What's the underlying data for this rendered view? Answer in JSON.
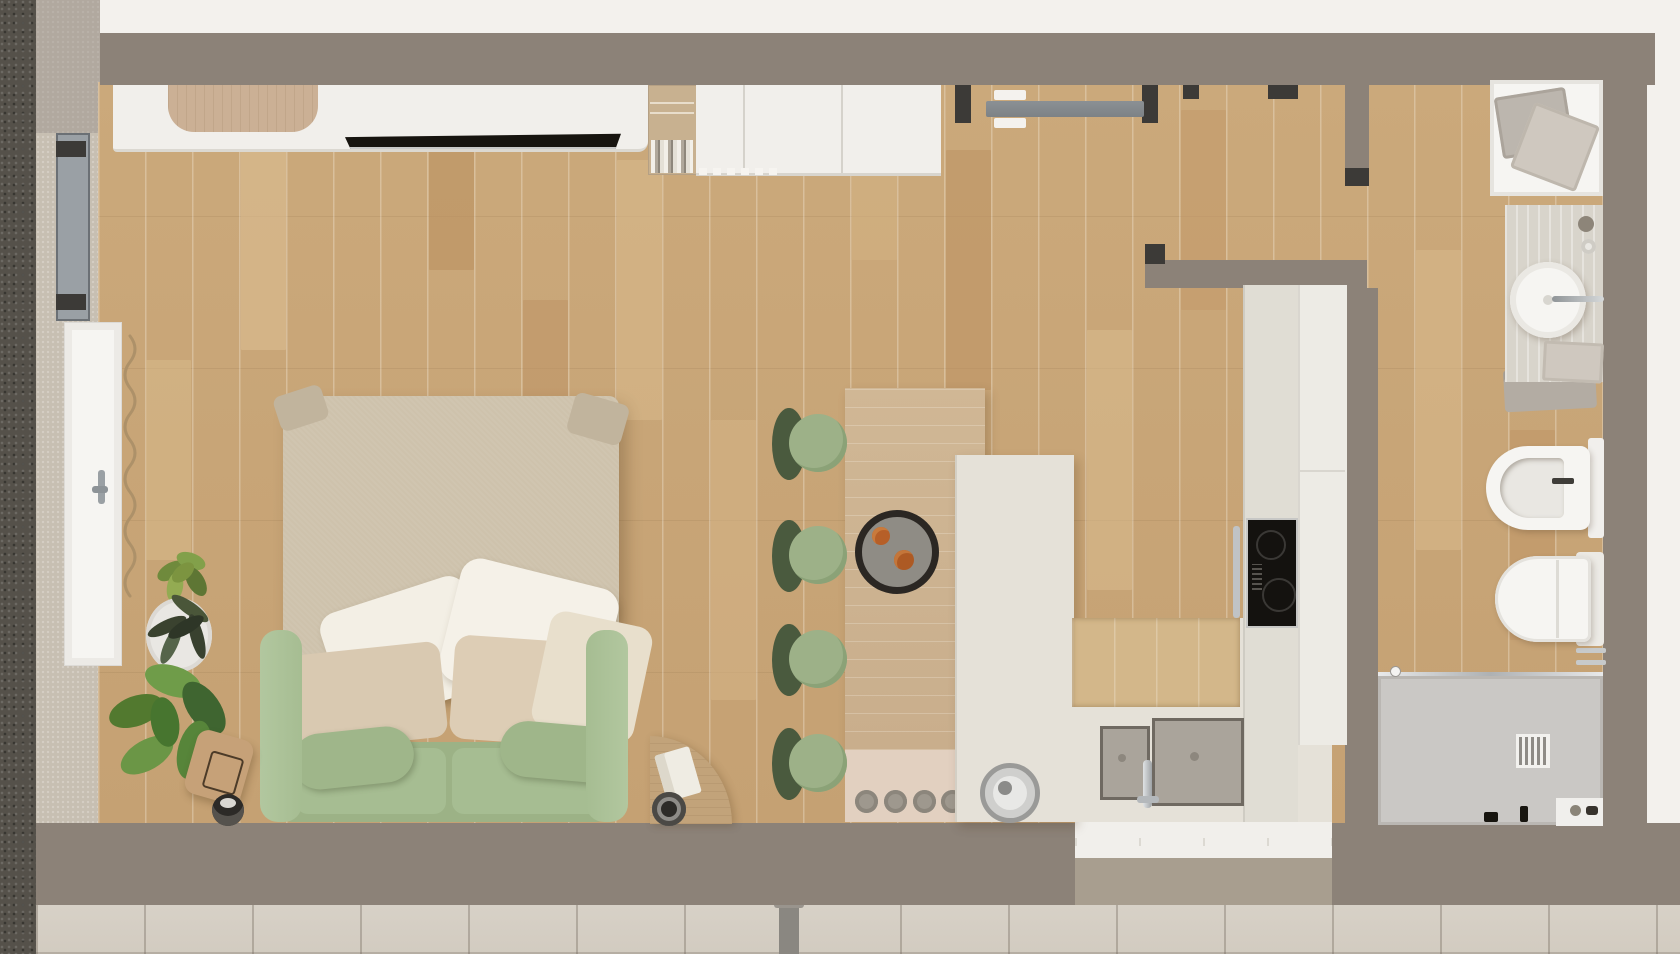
{
  "scene": {
    "type": "apartment-floor-plan-top-down-render",
    "rooms": [
      {
        "name": "living-dining-area",
        "floor": "oak-plank"
      },
      {
        "name": "kitchen",
        "floor": "oak-plank"
      },
      {
        "name": "entry-hallway",
        "floor": "oak-plank"
      },
      {
        "name": "bathroom",
        "floor": "oak-plank",
        "shower_floor": "stone-gray"
      },
      {
        "name": "exterior-terrace",
        "floor": "stone-tiles"
      }
    ],
    "furniture": [
      "media-sideboard",
      "built-in-desk",
      "flat-tv",
      "bookshelf-niche",
      "wall-cabinets",
      "entry-sliding-door",
      "green-sofa",
      "linen-throw-blanket",
      "white-pillows",
      "beige-pillows",
      "quarter-round-side-table",
      "puck-floor-lamp",
      "leather-pouf",
      "reading-glasses",
      "potted-plants",
      "wavy-curtain",
      "french-door",
      "casement-window",
      "dining-bar-table",
      "bar-stools-green",
      "round-serving-tray",
      "fruit",
      "spice-jars-row",
      "round-steel-sink",
      "kitchen-island",
      "kitchen-counter-run",
      "tall-cabinet-column",
      "induction-cooktop",
      "oven-handle",
      "double-basin-sink",
      "kitchen-faucet",
      "bath-tray-with-towels",
      "vanity-counter",
      "vessel-sink",
      "vanity-faucet",
      "soap-dispensers",
      "gray-towel",
      "bidet",
      "toilet",
      "shower-enclosure",
      "shower-glass-rail",
      "shower-drain",
      "shower-shelf",
      "towel-rail",
      "exterior-drain-pipe"
    ],
    "counts": {
      "bar_stools": 4,
      "spice_jars": 5,
      "plants": 3,
      "pillows": 7
    }
  },
  "palette": {
    "bg": "#f3f1ed",
    "wall": "#8c8278",
    "jamb": "#3c3a37",
    "floor": "#cba97b",
    "floor2": "#c5a173",
    "bar-wood": "#d0b795",
    "tile": "#d8d2c8",
    "gravel": "#55514a",
    "sill": "#c7bfb2",
    "cream": "#e5e1d8",
    "white": "#f1efeb",
    "taupe": "#a89e8f",
    "sofa-green": "#a6bd92",
    "sofa-green-deep": "#9cb286",
    "blanket": "#cec2ac",
    "pillow-white": "#f3efe5",
    "pillow-beige": "#d9c9b1",
    "stool-dark": "#4a5a3e",
    "stool-seat": "#9db188",
    "tray-ring": "#2b2723",
    "tray-center": "#8f8c85",
    "fruit-orange": "#b65f28",
    "steel": "#c0c3c5",
    "cooktop-black": "#14120f",
    "door-gray": "#7d8286",
    "frame-gray": "#9aa0a5",
    "curtain-tan": "#ad9169",
    "plant-dark": "#3a422f",
    "plant-mid": "#52792f",
    "plant-light": "#6f9c49",
    "shower-floor": "#cac8c5",
    "fixture-white": "#f6f5f2",
    "vanity-wood": "#d8d4cb",
    "towel-gray": "#b3aca3",
    "towel-beige": "#cfc8bf",
    "sink-gray": "#aaa49b",
    "planter-taupe": "#a89e8f",
    "pouf-tan": "#c6a178"
  }
}
